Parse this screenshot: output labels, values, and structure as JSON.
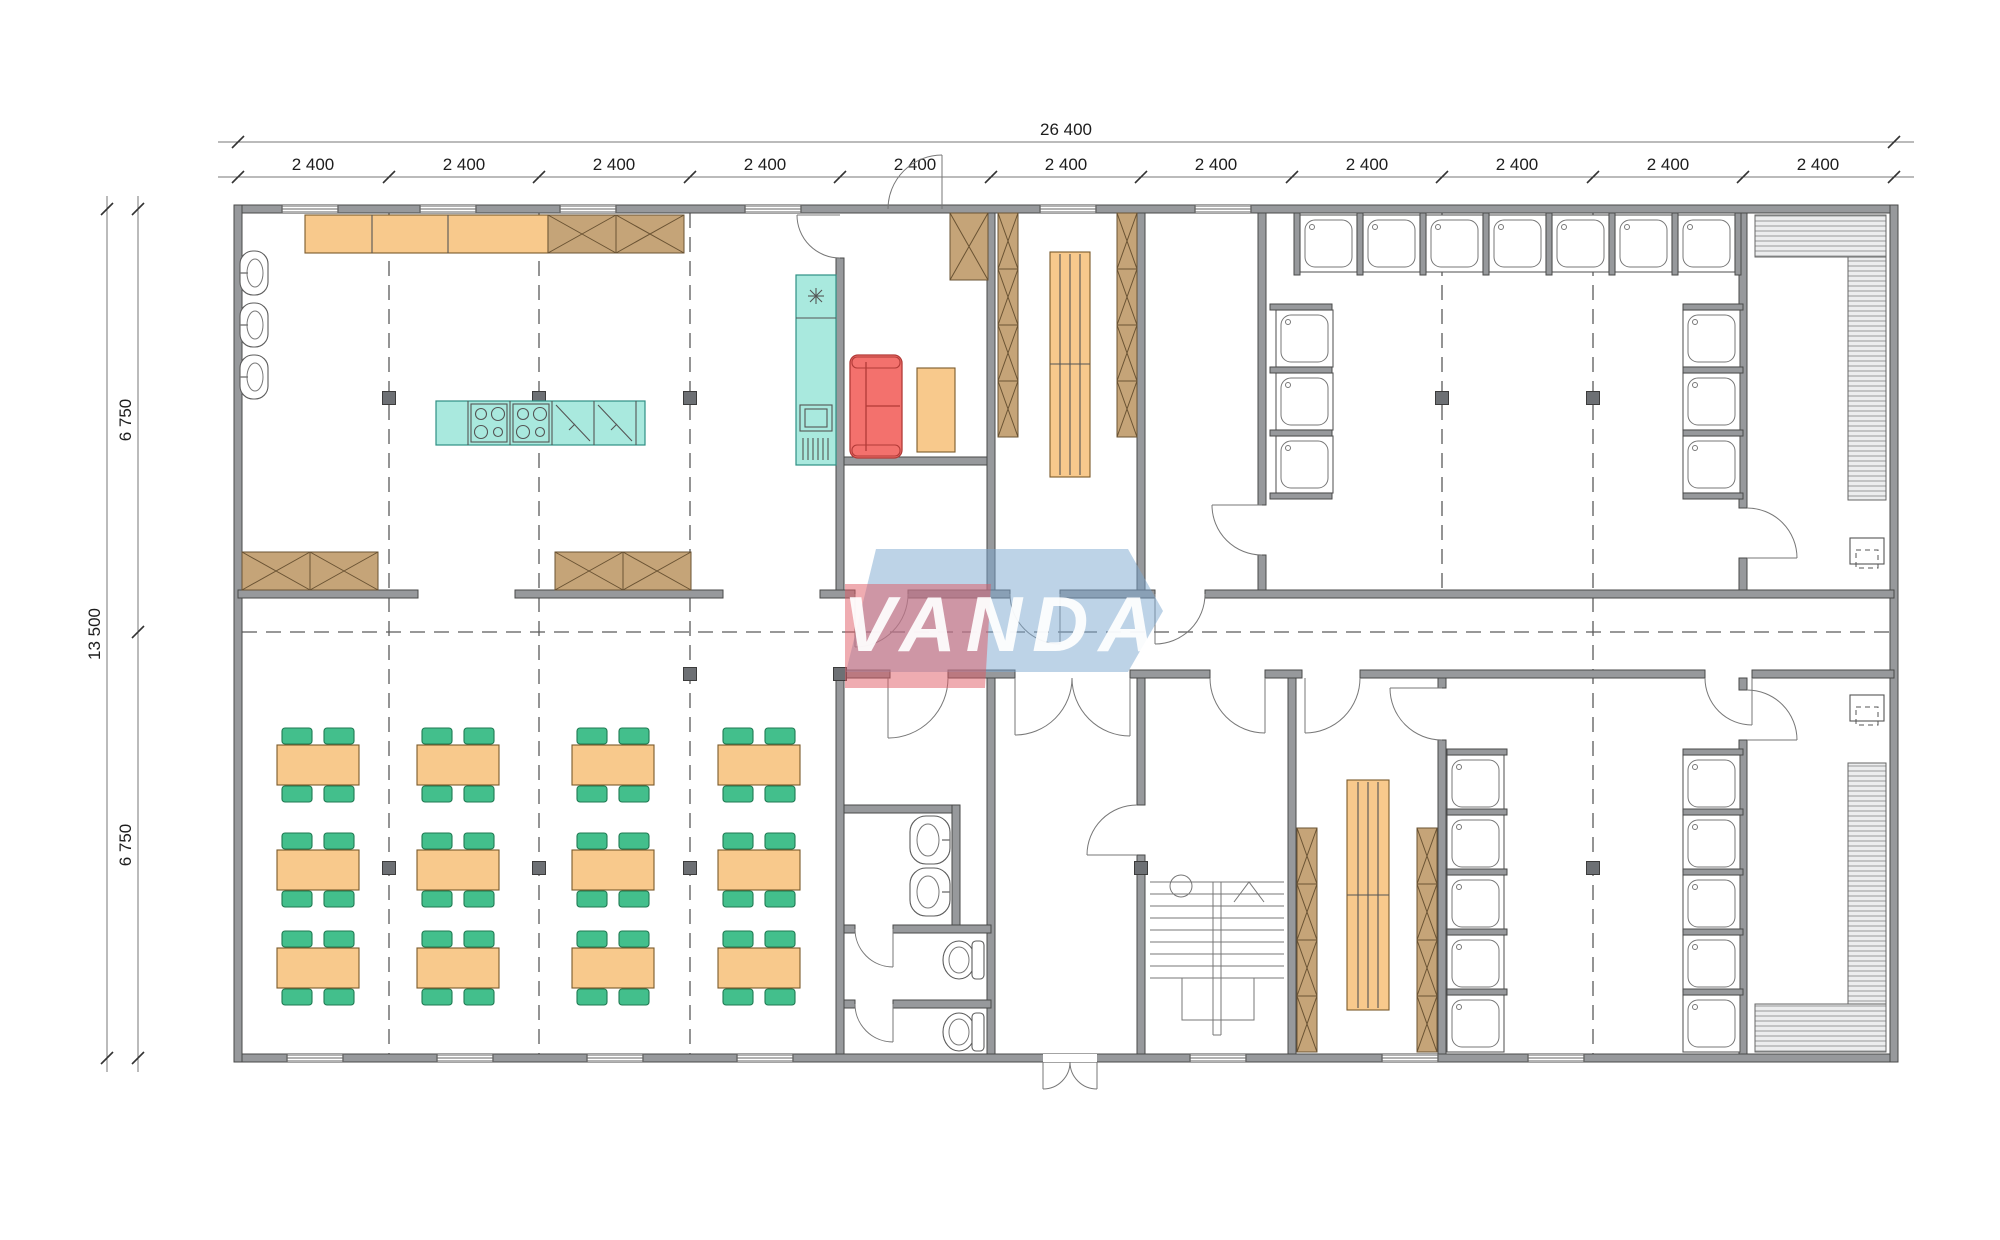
{
  "watermark": {
    "text": "VANDA"
  },
  "dimensions": {
    "top": {
      "total": "26 400",
      "segments": [
        "2 400",
        "2 400",
        "2 400",
        "2 400",
        "2 400",
        "2 400",
        "2 400",
        "2 400",
        "2 400",
        "2 400",
        "2 400"
      ]
    },
    "left": {
      "total": "13 500",
      "upper_half": "6 750",
      "lower_half": "6 750"
    }
  },
  "palette": {
    "wall": "#97999C",
    "furniture_orange": "#F8C98C",
    "chair_green": "#43BF8C",
    "kitchen_teal": "#A9E9DE",
    "sofa_red": "#F3716D",
    "cabinet_brown": "#C5A478",
    "watermark_red": "#E05A64",
    "watermark_blue": "#7BA7CF",
    "watermark_text": "#FFFFFF",
    "line": "#555555"
  },
  "symbols": [
    "dining-table-with-chairs",
    "kitchen-counter",
    "tall-cabinet-x",
    "cooktop",
    "kitchen-sink-unit",
    "refrigerator",
    "dishwasher",
    "sofa",
    "wash-basin",
    "toilet",
    "shower-tray",
    "storage-shelving",
    "sauna-bench",
    "sauna-heater",
    "staircase",
    "door-swing",
    "window",
    "structural-column",
    "grid-axis"
  ]
}
